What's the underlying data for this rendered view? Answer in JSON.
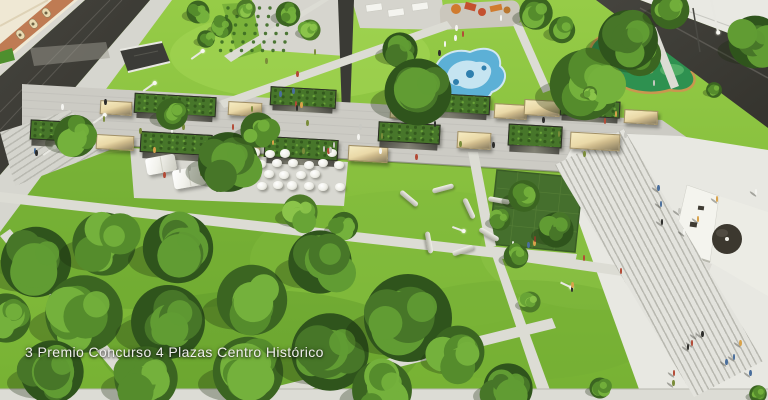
{
  "caption": {
    "text": "3 Premio Concurso 4 Plazas Centro Histórico"
  },
  "palette": {
    "grass_light": "#96cc47",
    "grass_dark": "#76b133",
    "road_dark": "#3b3a34",
    "pavement": "#d6d6cf",
    "plaza_white": "#e8e8e2",
    "promenade": "#cccbc4",
    "pergola_green": "#47762a",
    "kiosk_tan": "#ead9a8",
    "water_blue": "#5cb0d6",
    "golf_green": "#2e9150",
    "building_cream": "#efe8d4",
    "building_terracotta": "#bf7b53",
    "church_white": "#f4f4ee",
    "dome_dark": "#3c382f",
    "caption_color": "#efefec",
    "person_colors": [
      "#2d2d2b",
      "#f4f4f0",
      "#b34a36",
      "#c8c8c2",
      "#4a6e9c",
      "#d8a24a",
      "#7a8c3a"
    ]
  },
  "scene": {
    "trees": [
      [
        198,
        12,
        13,
        1
      ],
      [
        222,
        27,
        12,
        1
      ],
      [
        246,
        9,
        11,
        2
      ],
      [
        206,
        39,
        10,
        1
      ],
      [
        288,
        14,
        14,
        1
      ],
      [
        310,
        30,
        12,
        2
      ],
      [
        400,
        50,
        20,
        0
      ],
      [
        418,
        92,
        38,
        0
      ],
      [
        536,
        13,
        19,
        1
      ],
      [
        562,
        30,
        15,
        1
      ],
      [
        585,
        85,
        40,
        1
      ],
      [
        640,
        55,
        24,
        1
      ],
      [
        628,
        40,
        34,
        0
      ],
      [
        755,
        42,
        30,
        0
      ],
      [
        670,
        10,
        22,
        1
      ],
      [
        590,
        93,
        8,
        2
      ],
      [
        714,
        90,
        9,
        1
      ],
      [
        228,
        162,
        34,
        0
      ],
      [
        258,
        130,
        20,
        1
      ],
      [
        172,
        114,
        18,
        1
      ],
      [
        75,
        136,
        24,
        1
      ],
      [
        300,
        212,
        20,
        2
      ],
      [
        344,
        226,
        16,
        1
      ],
      [
        524,
        196,
        18,
        1
      ],
      [
        556,
        230,
        20,
        0
      ],
      [
        500,
        220,
        12,
        1
      ],
      [
        516,
        256,
        14,
        1
      ],
      [
        530,
        302,
        12,
        2
      ],
      [
        36,
        262,
        40,
        0
      ],
      [
        104,
        244,
        36,
        1
      ],
      [
        178,
        248,
        40,
        0
      ],
      [
        84,
        314,
        44,
        1
      ],
      [
        168,
        322,
        42,
        0
      ],
      [
        252,
        300,
        40,
        1
      ],
      [
        320,
        262,
        36,
        0
      ],
      [
        248,
        372,
        40,
        1
      ],
      [
        330,
        352,
        44,
        0
      ],
      [
        146,
        378,
        36,
        1
      ],
      [
        52,
        372,
        36,
        0
      ],
      [
        6,
        318,
        28,
        1
      ],
      [
        408,
        318,
        50,
        0
      ],
      [
        382,
        390,
        34,
        1
      ],
      [
        458,
        352,
        30,
        1
      ],
      [
        508,
        388,
        28,
        0
      ],
      [
        600,
        388,
        12,
        1
      ],
      [
        758,
        394,
        10,
        1
      ]
    ],
    "tree_tones": [
      [
        "#2f541c",
        "#477628",
        "#619c33"
      ],
      [
        "#3b6521",
        "#558c2c",
        "#74b13c"
      ],
      [
        "#4c7a28",
        "#68a436",
        "#8bc44a"
      ]
    ],
    "pavilions": {
      "rotation": 3.2,
      "upper": [
        [
          "k",
          100,
          101,
          32,
          14
        ],
        [
          "p",
          134,
          95,
          82,
          25
        ],
        [
          "k",
          228,
          102,
          34,
          14
        ],
        [
          "p",
          270,
          88,
          66,
          24
        ],
        [
          "k",
          390,
          104,
          33,
          15
        ],
        [
          "p",
          408,
          94,
          82,
          24
        ],
        [
          "k",
          494,
          104,
          33,
          15
        ],
        [
          "k",
          524,
          100,
          36,
          16
        ],
        [
          "p",
          560,
          100,
          60,
          22
        ],
        [
          "k",
          624,
          110,
          34,
          14
        ]
      ],
      "lower": [
        [
          "p",
          30,
          121,
          58,
          26
        ],
        [
          "k",
          96,
          135,
          38,
          15
        ],
        [
          "p",
          140,
          133,
          72,
          27
        ],
        [
          "k",
          222,
          140,
          38,
          15
        ],
        [
          "p",
          264,
          138,
          74,
          27
        ],
        [
          "k",
          348,
          146,
          40,
          16
        ],
        [
          "p",
          378,
          123,
          62,
          26
        ],
        [
          "k",
          457,
          132,
          34,
          17
        ],
        [
          "p",
          508,
          125,
          54,
          28
        ],
        [
          "k",
          570,
          133,
          50,
          17
        ]
      ]
    },
    "tents": [
      [
        146,
        156,
        30,
        17,
        -10
      ],
      [
        173,
        168,
        32,
        19,
        -10
      ]
    ],
    "umbrella_grid": {
      "x0": 248,
      "y0": 148,
      "cols": 6,
      "rows": 4,
      "dx": 15.5,
      "dy": 11,
      "diam": 10,
      "skip": 0.15
    },
    "garden": {
      "x0": 228,
      "y0": 8,
      "cols": 7,
      "rows": 6,
      "dx": 10.5,
      "dy": 8.5,
      "row_shift": -1.5,
      "dot_r": 1.7,
      "dot_color": "#3c6b24"
    },
    "logs": [
      [
        398,
        196,
        40
      ],
      [
        432,
        186,
        -15
      ],
      [
        458,
        206,
        65
      ],
      [
        478,
        232,
        30
      ],
      [
        452,
        248,
        -20
      ],
      [
        418,
        240,
        80
      ],
      [
        488,
        198,
        10
      ]
    ],
    "lamps": [
      [
        42,
        150,
        -35,
        14
      ],
      [
        92,
        118,
        -35,
        14
      ],
      [
        142,
        86,
        -35,
        14
      ],
      [
        190,
        54,
        -35,
        14
      ],
      [
        452,
        228,
        20,
        12
      ],
      [
        560,
        284,
        25,
        12
      ],
      [
        694,
        12,
        78,
        40
      ],
      [
        240,
        128,
        10,
        12
      ]
    ],
    "people_clusters": [
      {
        "x": 30,
        "y": 96,
        "w": 600,
        "h": 58,
        "n": 34
      },
      {
        "x": 262,
        "y": 30,
        "w": 70,
        "h": 78,
        "n": 9
      },
      {
        "x": 282,
        "y": 120,
        "w": 90,
        "h": 30,
        "n": 6
      },
      {
        "x": 430,
        "y": 12,
        "w": 90,
        "h": 42,
        "n": 6
      },
      {
        "x": 598,
        "y": 38,
        "w": 96,
        "h": 52,
        "n": 5
      },
      {
        "x": 636,
        "y": 330,
        "w": 125,
        "h": 58,
        "n": 10,
        "shadow": true
      },
      {
        "x": 652,
        "y": 180,
        "w": 108,
        "h": 55,
        "n": 8,
        "shadow": true
      },
      {
        "x": 540,
        "y": 252,
        "w": 90,
        "h": 36,
        "n": 4
      },
      {
        "x": 496,
        "y": 186,
        "w": 70,
        "h": 58,
        "n": 5
      },
      {
        "x": 160,
        "y": 158,
        "w": 60,
        "h": 30,
        "n": 5
      }
    ]
  }
}
